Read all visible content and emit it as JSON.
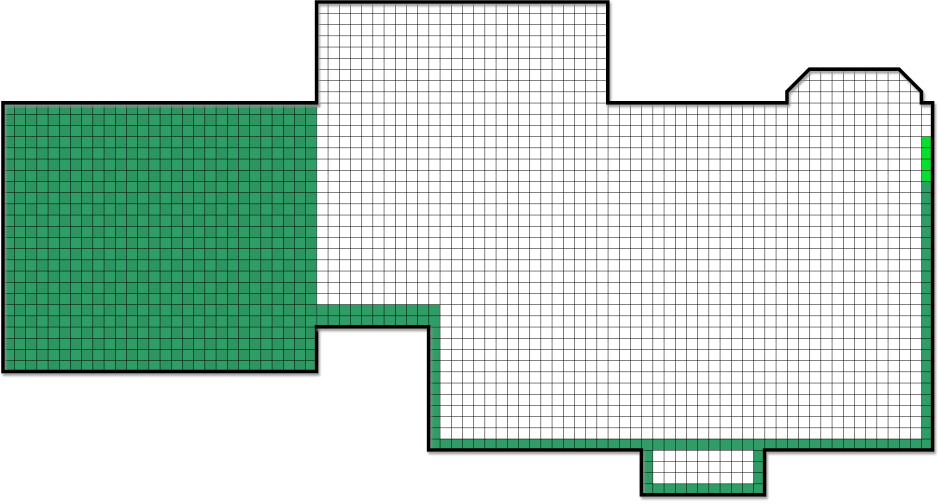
{
  "scene": {
    "name": "grid-territory-map",
    "width": 939,
    "height": 504,
    "background": "#ffffff",
    "cell_size": 11.2,
    "grid_origin": {
      "x": 3,
      "y": 2
    },
    "colors": {
      "grid_line": "#000000",
      "outline": "#000000",
      "shadow": "#8f8f8f",
      "claimed": "#2f9e66",
      "claimed_checker": "rgba(0,0,0,0.06)",
      "active": "#06df2e",
      "unclaimed": "#ffffff"
    },
    "shapes": [
      {
        "name": "left-room-area",
        "kind": "polygon",
        "fill": "claimed",
        "grid": true,
        "checker": true,
        "interactable": true,
        "points": [
          [
            3,
            102.8
          ],
          [
            316.6,
            102.8
          ],
          [
            316.6,
            371.6
          ],
          [
            3,
            371.6
          ]
        ]
      },
      {
        "name": "right-room-area",
        "kind": "polygon",
        "fill": "unclaimed",
        "grid": true,
        "interactable": true,
        "points": [
          [
            316.6,
            2
          ],
          [
            607.8,
            2
          ],
          [
            607.8,
            102.8
          ],
          [
            787,
            102.8
          ],
          [
            787,
            91.6
          ],
          [
            809.4,
            69.2
          ],
          [
            899,
            69.2
          ],
          [
            921.4,
            91.6
          ],
          [
            921.4,
            102.8
          ],
          [
            932.6,
            102.8
          ],
          [
            932.6,
            450
          ],
          [
            764.6,
            450
          ],
          [
            764.6,
            494.8
          ],
          [
            641.4,
            494.8
          ],
          [
            641.4,
            450
          ],
          [
            428.6,
            450
          ],
          [
            428.6,
            326.8
          ],
          [
            316.6,
            326.8
          ]
        ]
      },
      {
        "name": "claimed-band",
        "kind": "rect",
        "fill": "claimed",
        "interactable": false,
        "x": 316.6,
        "y": 304.4,
        "w": 123.2,
        "h": 22.4
      },
      {
        "name": "claimed-column",
        "kind": "rect",
        "fill": "claimed",
        "interactable": false,
        "x": 428.6,
        "y": 326.8,
        "w": 11.2,
        "h": 123.2
      },
      {
        "name": "claimed-bottom-row",
        "kind": "rect",
        "fill": "claimed",
        "interactable": false,
        "x": 428.6,
        "y": 438.8,
        "w": 504,
        "h": 11.2
      },
      {
        "name": "claimed-notch-left",
        "kind": "rect",
        "fill": "claimed",
        "interactable": false,
        "x": 641.4,
        "y": 450,
        "w": 11.2,
        "h": 44.8
      },
      {
        "name": "claimed-notch-bottom",
        "kind": "rect",
        "fill": "claimed",
        "interactable": false,
        "x": 641.4,
        "y": 483.6,
        "w": 123.2,
        "h": 11.2
      },
      {
        "name": "claimed-notch-right",
        "kind": "rect",
        "fill": "claimed",
        "interactable": false,
        "x": 753.4,
        "y": 450,
        "w": 11.2,
        "h": 44.8
      },
      {
        "name": "claimed-right-column",
        "kind": "rect",
        "fill": "claimed",
        "interactable": false,
        "x": 921.4,
        "y": 181.2,
        "w": 11.2,
        "h": 268.8
      },
      {
        "name": "active-cells",
        "kind": "rect",
        "fill": "active",
        "interactable": false,
        "x": 921.4,
        "y": 136.4,
        "w": 11.2,
        "h": 44.8
      }
    ],
    "borders": [
      {
        "name": "left-room-border",
        "width": 3.6,
        "points": [
          [
            316.6,
            102.8
          ],
          [
            3,
            102.8
          ],
          [
            3,
            371.6
          ],
          [
            316.6,
            371.6
          ],
          [
            316.6,
            326.8
          ]
        ]
      },
      {
        "name": "right-room-border",
        "width": 3.6,
        "points": [
          [
            316.6,
            102.8
          ],
          [
            316.6,
            2
          ],
          [
            607.8,
            2
          ],
          [
            607.8,
            102.8
          ],
          [
            787,
            102.8
          ],
          [
            787,
            91.6
          ],
          [
            809.4,
            69.2
          ],
          [
            899,
            69.2
          ],
          [
            921.4,
            91.6
          ],
          [
            921.4,
            102.8
          ],
          [
            932.6,
            102.8
          ],
          [
            932.6,
            450
          ],
          [
            764.6,
            450
          ],
          [
            764.6,
            494.8
          ],
          [
            641.4,
            494.8
          ],
          [
            641.4,
            450
          ],
          [
            428.6,
            450
          ],
          [
            428.6,
            326.8
          ],
          [
            316.6,
            326.8
          ]
        ]
      }
    ]
  }
}
